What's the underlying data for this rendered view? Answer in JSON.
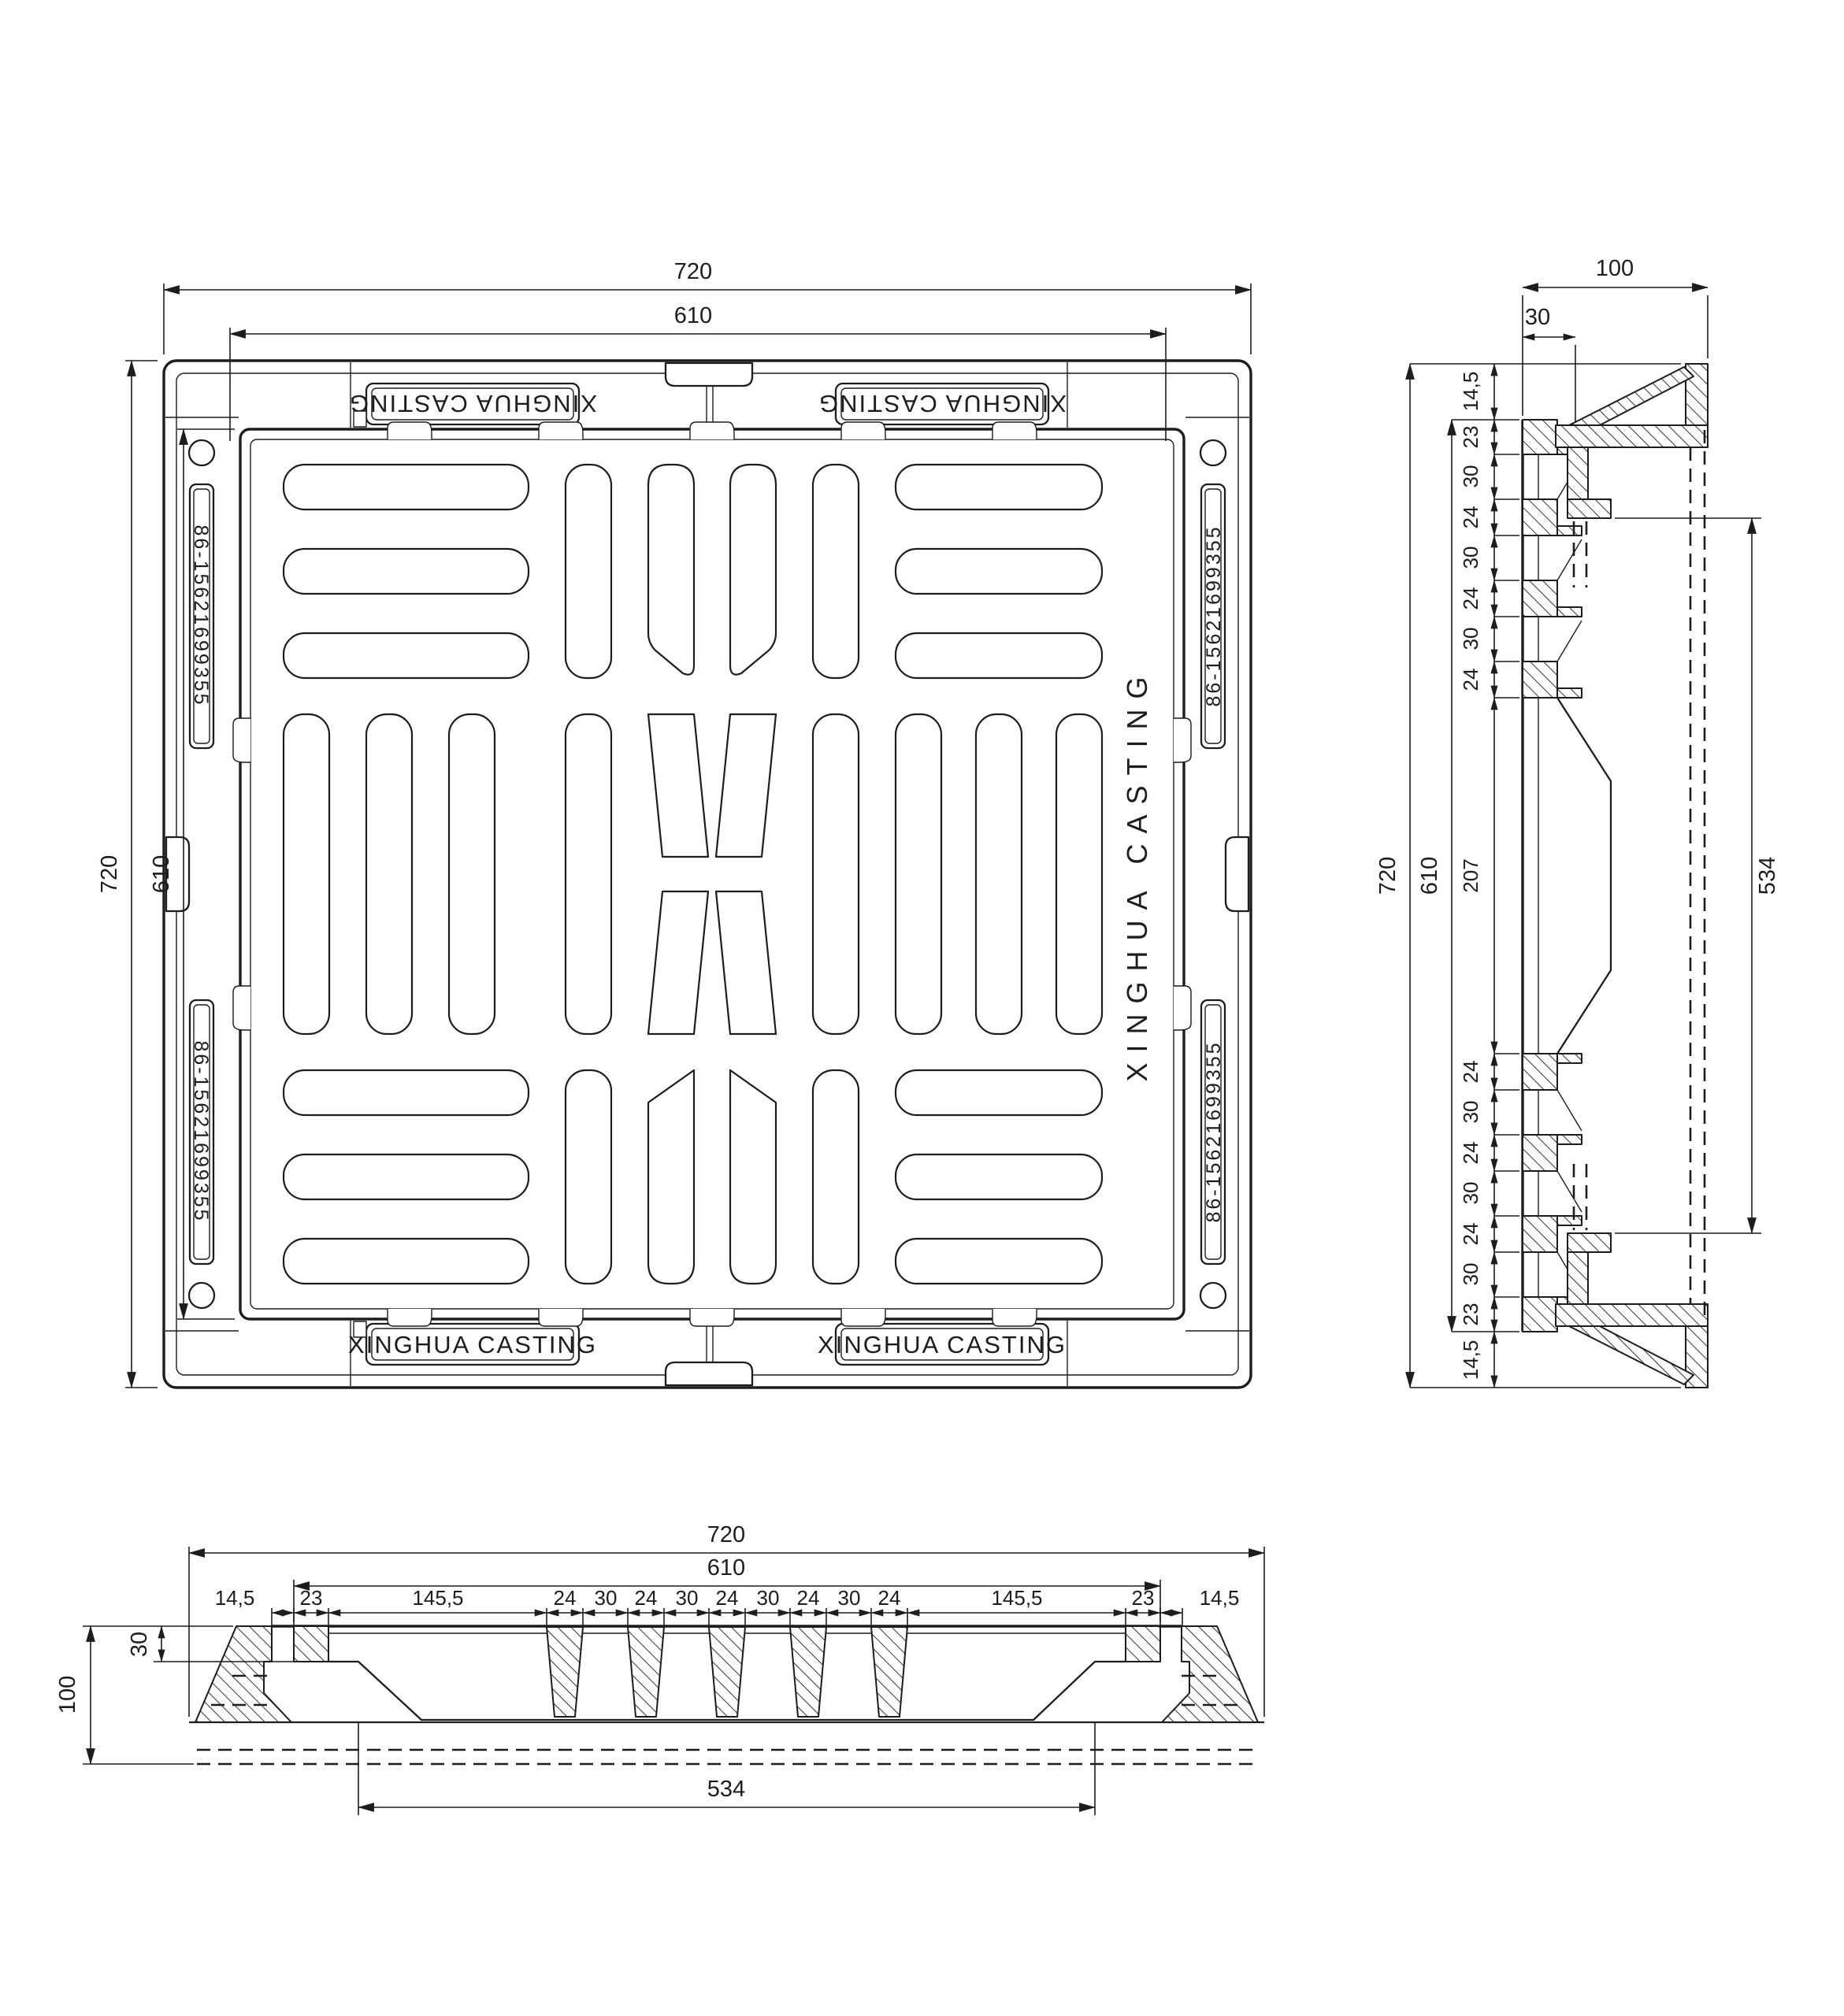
{
  "page": {
    "background": "#ffffff",
    "line_color": "#1d1d1d"
  },
  "brand": {
    "plaque": "XINGHUA CASTING",
    "phone": "86-15621699355",
    "engraving": "XINGHUA CASTING"
  },
  "plan": {
    "top_outer": "720",
    "top_inner": "610",
    "left_outer": "720",
    "left_inner": "610"
  },
  "side": {
    "width": "100",
    "lip": "30",
    "outer": "720",
    "inner": "610",
    "clear": "534",
    "chain": [
      "14,5",
      "23",
      "30",
      "24",
      "30",
      "24",
      "30",
      "24",
      "207",
      "24",
      "30",
      "24",
      "30",
      "24",
      "30",
      "23",
      "14,5"
    ]
  },
  "bottom": {
    "outer": "720",
    "inner": "610",
    "height": "100",
    "lip": "30",
    "clear": "534",
    "chain": [
      "14,5",
      "23",
      "145,5",
      "24",
      "30",
      "24",
      "30",
      "24",
      "30",
      "24",
      "30",
      "24",
      "145,5",
      "23",
      "14,5"
    ]
  }
}
